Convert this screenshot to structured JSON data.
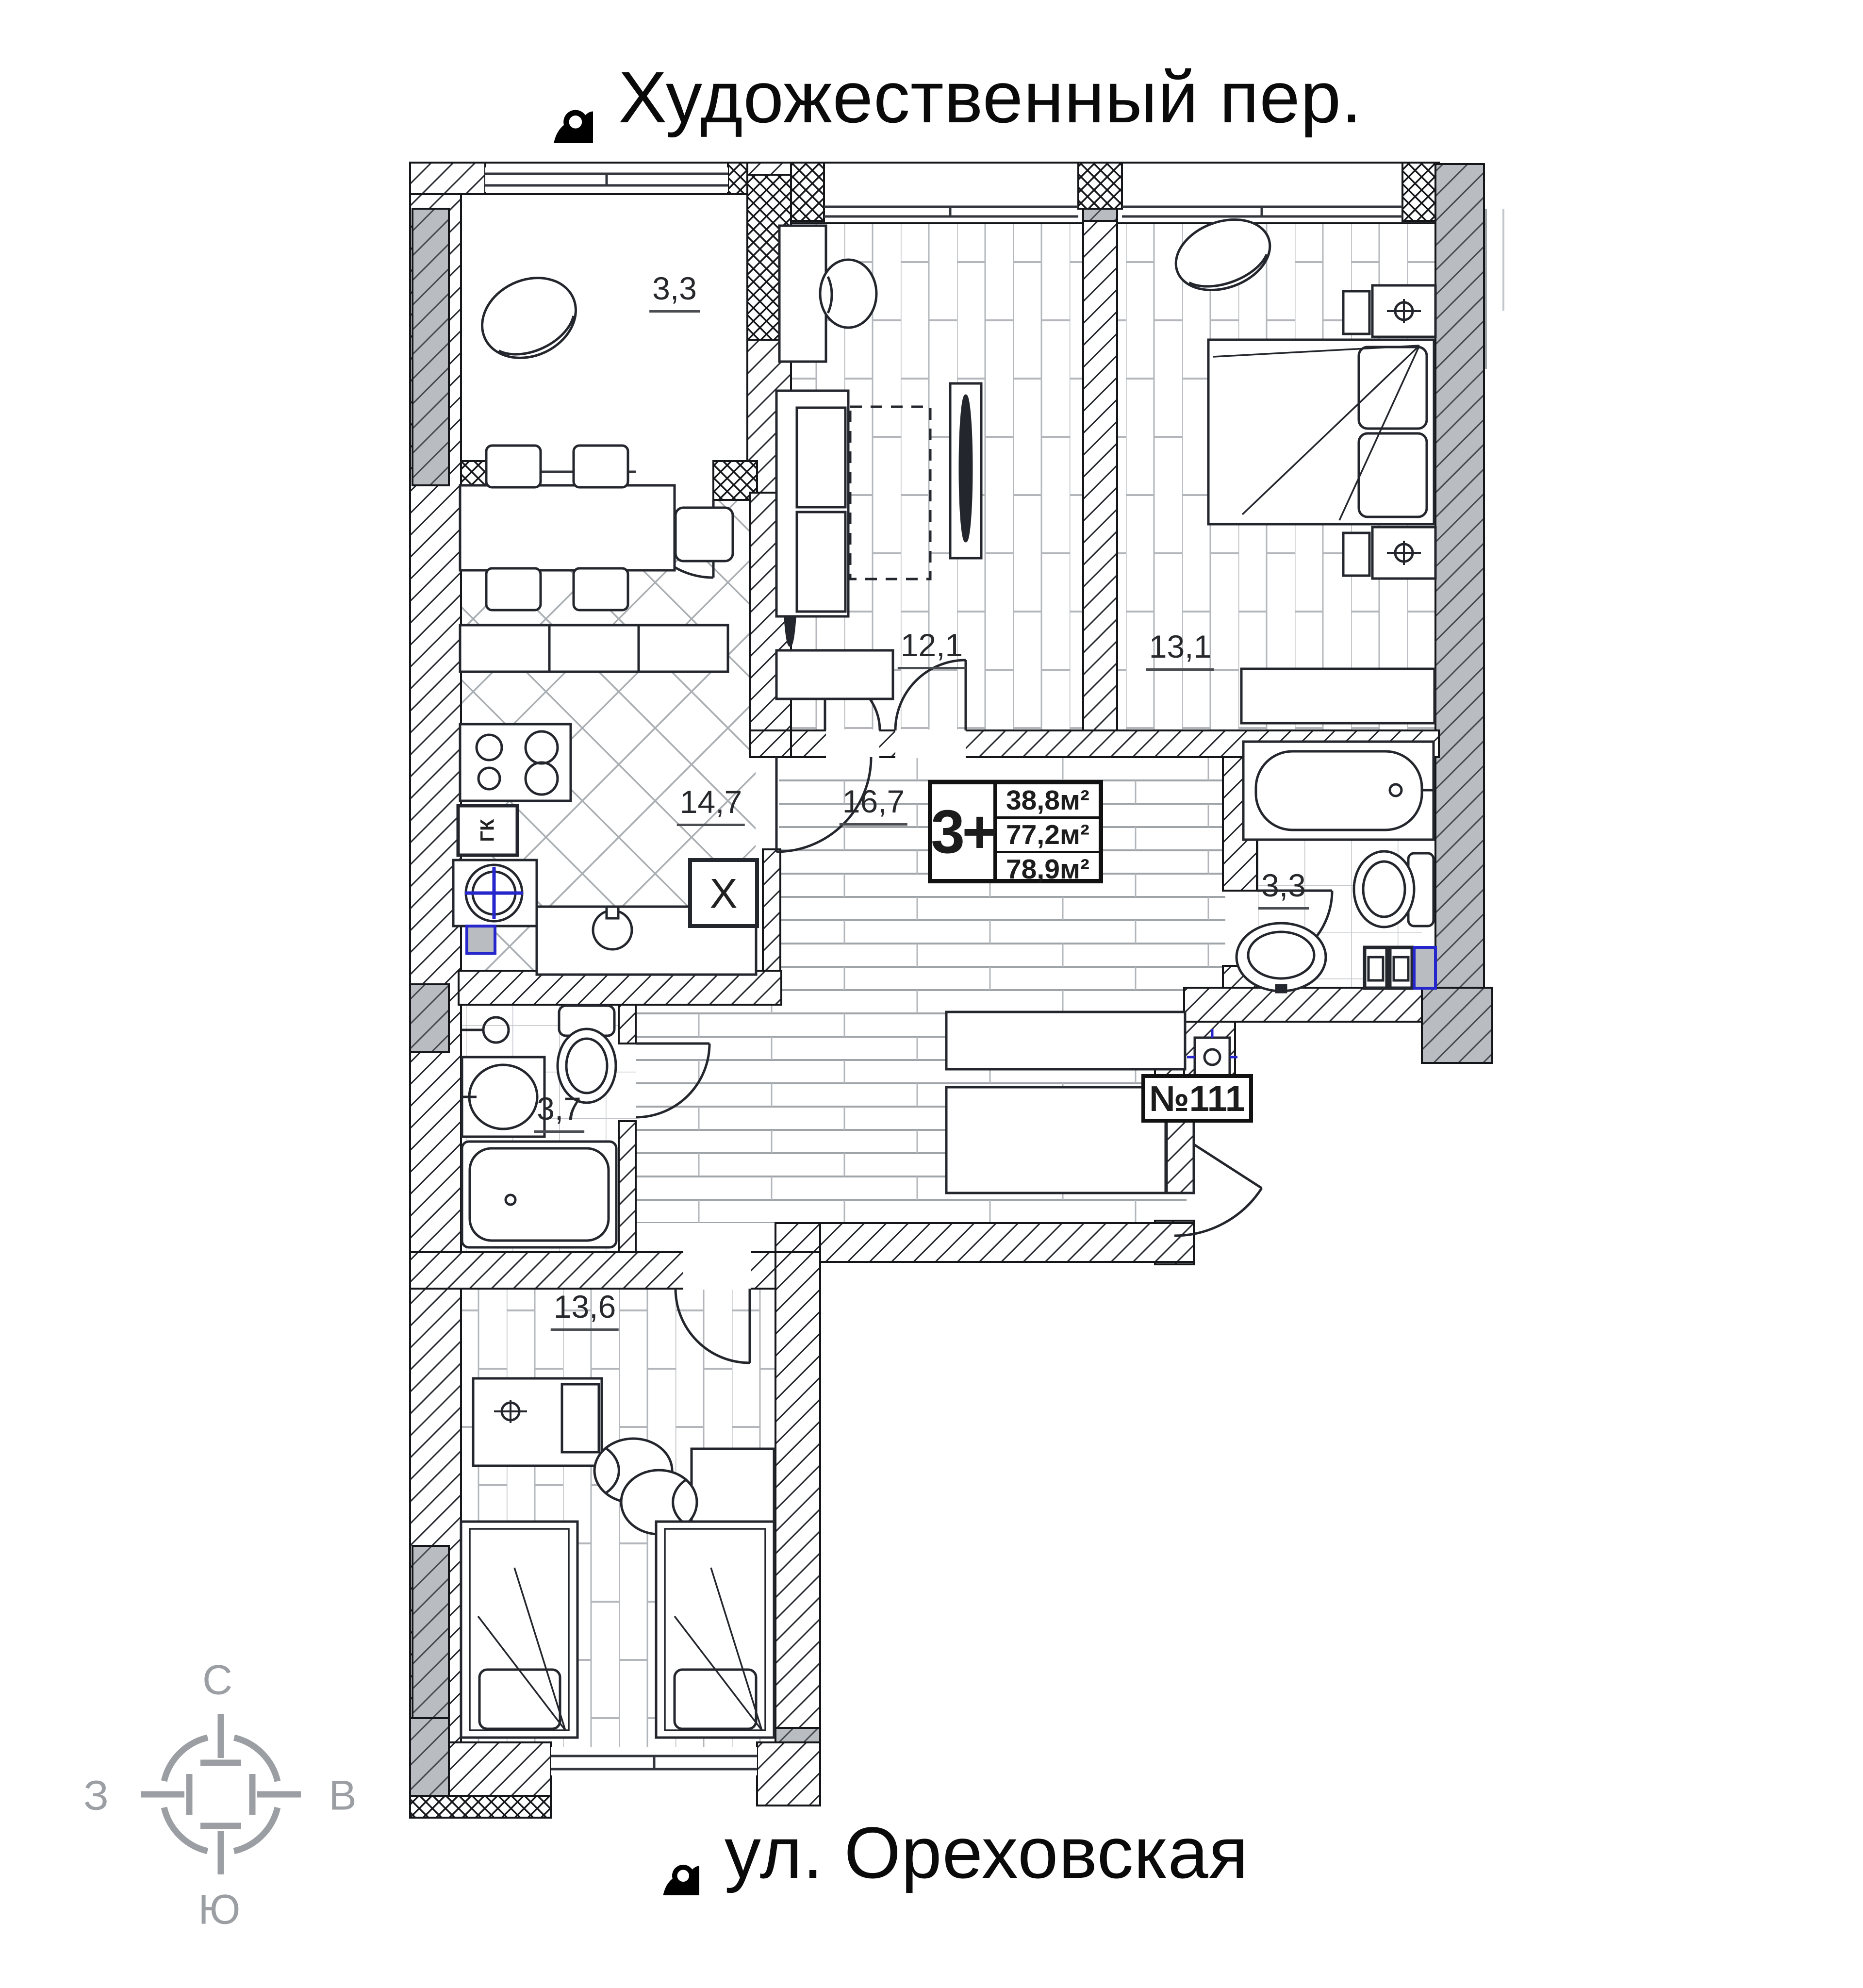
{
  "colors": {
    "background": "#ffffff",
    "ink": "#20232a",
    "wall_gray": "#b9bdc2",
    "floor_line": "#b3b7bb",
    "accent_blue": "#2526cb",
    "compass_gray": "#9b9fa3"
  },
  "header": {
    "title": "Художественный пер."
  },
  "footer": {
    "title": "ул. Ореховская"
  },
  "compass": {
    "north": "С",
    "east": "В",
    "south": "Ю",
    "west": "З"
  },
  "info_box": {
    "type": "3+",
    "rows": [
      "38,8м²",
      "77,2м²",
      "78,9м²"
    ]
  },
  "entrance": {
    "number": "№111"
  },
  "rooms": [
    {
      "id": "balcony-top",
      "area": "3,3"
    },
    {
      "id": "kitchen-living",
      "area": "14,7"
    },
    {
      "id": "bedroom-1",
      "area": "12,1"
    },
    {
      "id": "bedroom-2",
      "area": "13,1"
    },
    {
      "id": "hallway",
      "area": "16,7"
    },
    {
      "id": "bathroom",
      "area": "3,3"
    },
    {
      "id": "toilet",
      "area": "3,7"
    },
    {
      "id": "bedroom-3",
      "area": "13,6"
    }
  ],
  "labels": {
    "gas_boiler": "ГК",
    "vent": "X"
  },
  "icons": {
    "top_street": "binoculars-icon",
    "bottom_street": "binoculars-icon",
    "compass": "compass-rose-icon"
  }
}
